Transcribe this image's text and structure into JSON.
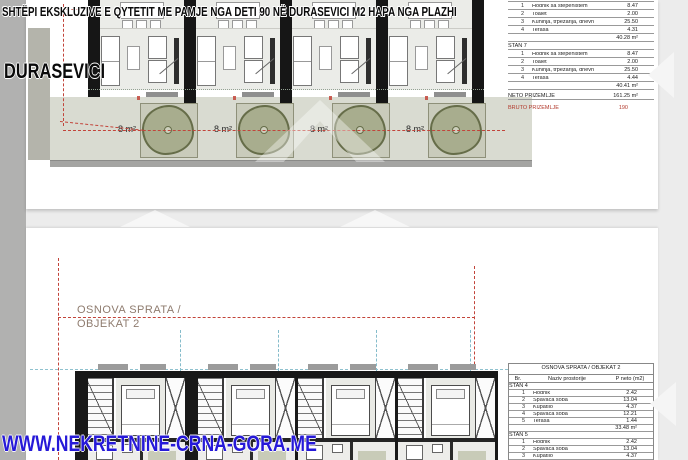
{
  "banner": {
    "title": "SHTËPI EKSKLUZIVE E QYTETIT ME PAMJE NGA DETI 90 NË DURASEVICI M2 HAPA NGA PLAZHI"
  },
  "overlays": {
    "location_label": "DURASEVICI",
    "website": "WWW.NEKRETNINE-CRNA-GORA.ME"
  },
  "ground_floor_plan": {
    "terraces": [
      {
        "label": "8 m²"
      },
      {
        "label": "8 m²"
      },
      {
        "label": "8 m²"
      },
      {
        "label": "8 m²"
      }
    ]
  },
  "upper_floor_plan": {
    "title_line1": "OSNOVA SPRATA /",
    "title_line2": "OBJEKAT 2"
  },
  "area_table_ground": {
    "section1": {
      "rows": [
        {
          "num": "1",
          "name": "Hodnik sa stepeništem",
          "area": "8.47"
        },
        {
          "num": "2",
          "name": "Toalet",
          "area": "2.00"
        },
        {
          "num": "3",
          "name": "Kuhinja, trpezarija, dnevna",
          "area": "25.50"
        },
        {
          "num": "4",
          "name": "Terasa",
          "area": "4.31"
        }
      ],
      "total": "40.28 m²"
    },
    "section2": {
      "label": "STAN 7",
      "rows": [
        {
          "num": "1",
          "name": "Hodnik sa stepeništem",
          "area": "8.47"
        },
        {
          "num": "2",
          "name": "Toalet",
          "area": "2.00"
        },
        {
          "num": "3",
          "name": "Kuhinja, trpezarija, dnevna",
          "area": "25.50"
        },
        {
          "num": "4",
          "name": "Terasa",
          "area": "4.44"
        }
      ],
      "total": "40.41 m²"
    },
    "neto": {
      "label": "NETO PRIZEMLJE",
      "value": "161.25 m²"
    },
    "bruto": {
      "label": "BRUTO PRIZEMLJE",
      "value": "190"
    }
  },
  "area_table_upper": {
    "title": "OSNOVA SPRATA / OBJEKAT 2",
    "columns": {
      "num": "Br.",
      "name": "Naziv prostorije",
      "area": "P neto (m2)"
    },
    "stan4": {
      "label": "STAN 4",
      "rows": [
        {
          "num": "1",
          "name": "Hodnik",
          "area": "2.42"
        },
        {
          "num": "2",
          "name": "Spavaća soba",
          "area": "13.04"
        },
        {
          "num": "3",
          "name": "Kupatilo",
          "area": "4.37"
        },
        {
          "num": "4",
          "name": "Spavaća soba",
          "area": "12.21"
        },
        {
          "num": "5",
          "name": "Terasa",
          "area": "1.44"
        }
      ],
      "total": "33.48 m²"
    },
    "stan5": {
      "label": "STAN 5",
      "rows": [
        {
          "num": "1",
          "name": "Hodnik",
          "area": "2.42"
        },
        {
          "num": "2",
          "name": "Spavaća soba",
          "area": "13.04"
        },
        {
          "num": "3",
          "name": "Kupatilo",
          "area": "4.37"
        },
        {
          "num": "4",
          "name": "Spavaća soba",
          "area": "12.21"
        },
        {
          "num": "5",
          "name": "Terasa",
          "area": "1.88"
        }
      ]
    }
  },
  "colors": {
    "accent_red_dash": "#c2443a",
    "dash_cyan": "#8fc2cf",
    "website_blue": "#2619d8",
    "tree_olive": "#a8ad8e",
    "table_red": "#b2392c",
    "wall_black": "#161616"
  }
}
